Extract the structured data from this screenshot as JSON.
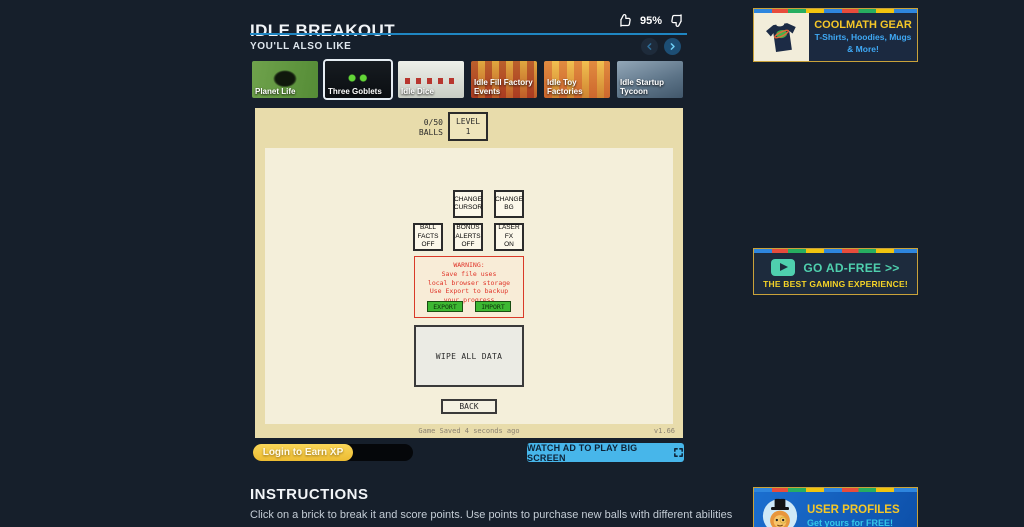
{
  "colors": {
    "page_bg": "#161f2b",
    "header_divider_blue": "#1f86c2",
    "game_outer_tan": "#e8dcab",
    "game_inner_cream": "#f4efda",
    "warning_red": "#e03428",
    "export_import_green": "#3db832",
    "xp_yellow": "#f2c63f",
    "watch_ad_cyan": "#47b6ea",
    "ad_border_gold": "#c9a23a",
    "ad_title_yellow": "#f5c728",
    "adfree_teal": "#4fd0ae",
    "gear_subtitle_blue": "#3fa9f5",
    "profiles_subtitle_cyan": "#35c7e8"
  },
  "icons": {
    "thumbs_up": "thumbs-up outline glyph",
    "thumbs_down": "thumbs-down outline glyph",
    "chevron_left": "circular prev arrow",
    "chevron_right": "circular next arrow",
    "expand": "fullscreen corner arrows",
    "play": "rounded play button",
    "tshirt": "coolmath t-shirt graphic",
    "lion_avatar": "lion with top hat avatar"
  },
  "header": {
    "title": "IDLE BREAKOUT",
    "like_percent": "95%",
    "also_like_label": "YOU'LL ALSO LIKE"
  },
  "carousel": {
    "items": [
      {
        "label": "Planet Life"
      },
      {
        "label": "Three Goblets"
      },
      {
        "label": "Idle Dice"
      },
      {
        "label": "Idle Fill Factory Events"
      },
      {
        "label": "Idle Toy Factories"
      },
      {
        "label": "Idle Startup Tycoon"
      }
    ]
  },
  "game": {
    "balls": "0/50\nBALLS",
    "level_label": "LEVEL",
    "level_value": "1",
    "buttons": {
      "change_cursor": "CHANGE\nCURSOR",
      "change_bg": "CHANGE\nBG",
      "ball_facts": "BALL\nFACTS\nOFF",
      "bonus_alerts": "BONUS\nALERTS\nOFF",
      "laser_fx": "LASER\nFX\nON"
    },
    "warning": {
      "text": "WARNING:\nSave file uses\nlocal browser storage\nUse Export to backup\nyour progress",
      "export_label": "EXPORT",
      "import_label": "IMPORT"
    },
    "wipe_label": "WIPE ALL DATA",
    "back_label": "BACK",
    "save_status": "Game Saved 4 seconds ago",
    "version": "v1.66"
  },
  "footer": {
    "xp_button": "Login to Earn XP",
    "watch_ad_button": "WATCH AD TO PLAY BIG SCREEN"
  },
  "instructions": {
    "heading": "INSTRUCTIONS",
    "body": "Click on a brick to break it and score points. Use points to purchase new balls with different abilities and upgrade them. Balls will automatically bounce and break bricks to score more points."
  },
  "ads": {
    "gear": {
      "title": "COOLMATH GEAR",
      "subtitle": "T-Shirts, Hoodies, Mugs & More!"
    },
    "adfree": {
      "title": "GO AD-FREE >>",
      "subtitle": "THE BEST GAMING EXPERIENCE!"
    },
    "profiles": {
      "title": "USER PROFILES",
      "subtitle": "Get yours for FREE!"
    }
  }
}
